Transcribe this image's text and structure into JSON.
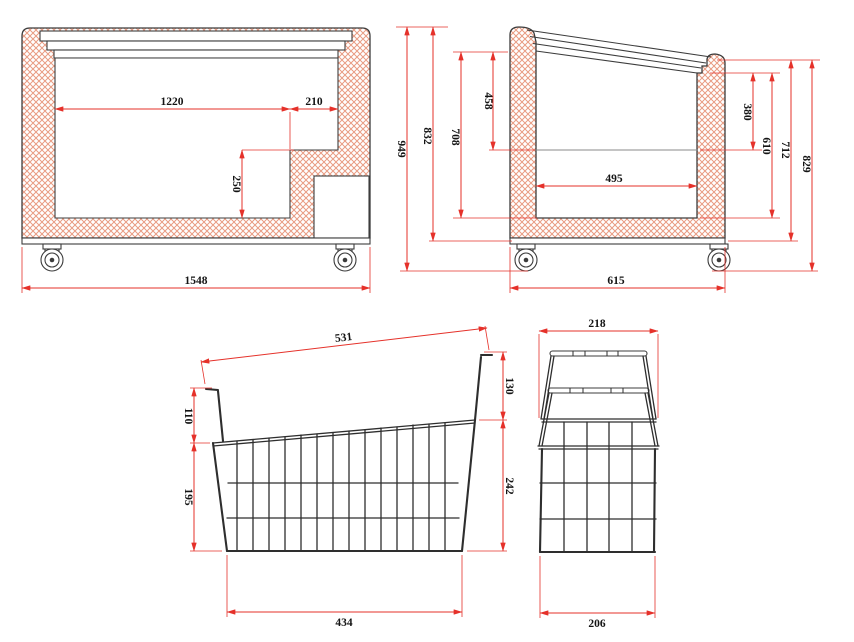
{
  "colors": {
    "dimension": "#e5312a",
    "line": "#3c3c3c",
    "hatch": "#e89b82",
    "wire": "#2e2e2e"
  },
  "dims": {
    "front": {
      "inner_width": "1220",
      "right_section_width": "210",
      "step_height": "250",
      "overall_width": "1548"
    },
    "side": {
      "overall_height": "949",
      "body_height": "832",
      "inner_depth": "708",
      "lid_to_shelf": "458",
      "inner_length": "495",
      "right_top_to_shelf": "380",
      "right_inner_depth": "610",
      "right_body_height": "712",
      "right_overall_height": "829",
      "base_width": "615"
    },
    "basket_side": {
      "top_length": "531",
      "left_hook_height": "110",
      "left_body_height": "195",
      "right_hook_height": "130",
      "right_body_height": "242",
      "bottom_length": "434"
    },
    "basket_end": {
      "top_width": "218",
      "bottom_width": "206"
    }
  }
}
